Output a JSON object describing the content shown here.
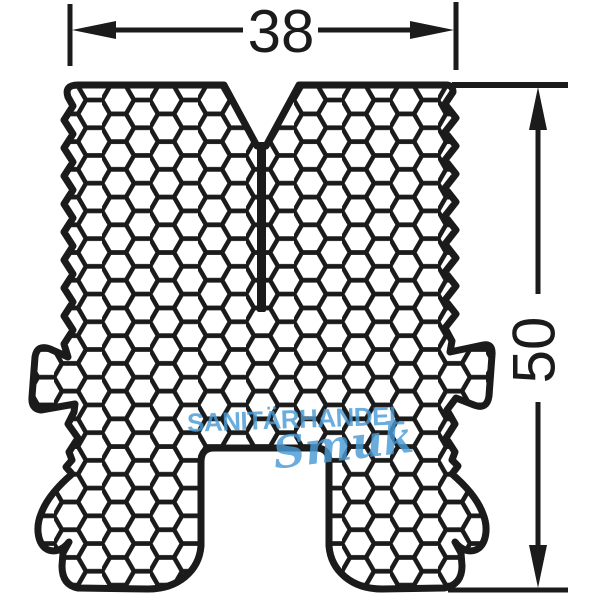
{
  "drawing": {
    "type": "technical-profile-cross-section",
    "dimensions": {
      "width": {
        "value": "38"
      },
      "height": {
        "value": "50"
      }
    }
  },
  "watermark": {
    "line1": "SANITÄRHANDEL",
    "line2": "Smuk"
  },
  "colors": {
    "line": "#1b1b1b",
    "watermark_blue": "#4a9bd5",
    "background": "#ffffff"
  }
}
